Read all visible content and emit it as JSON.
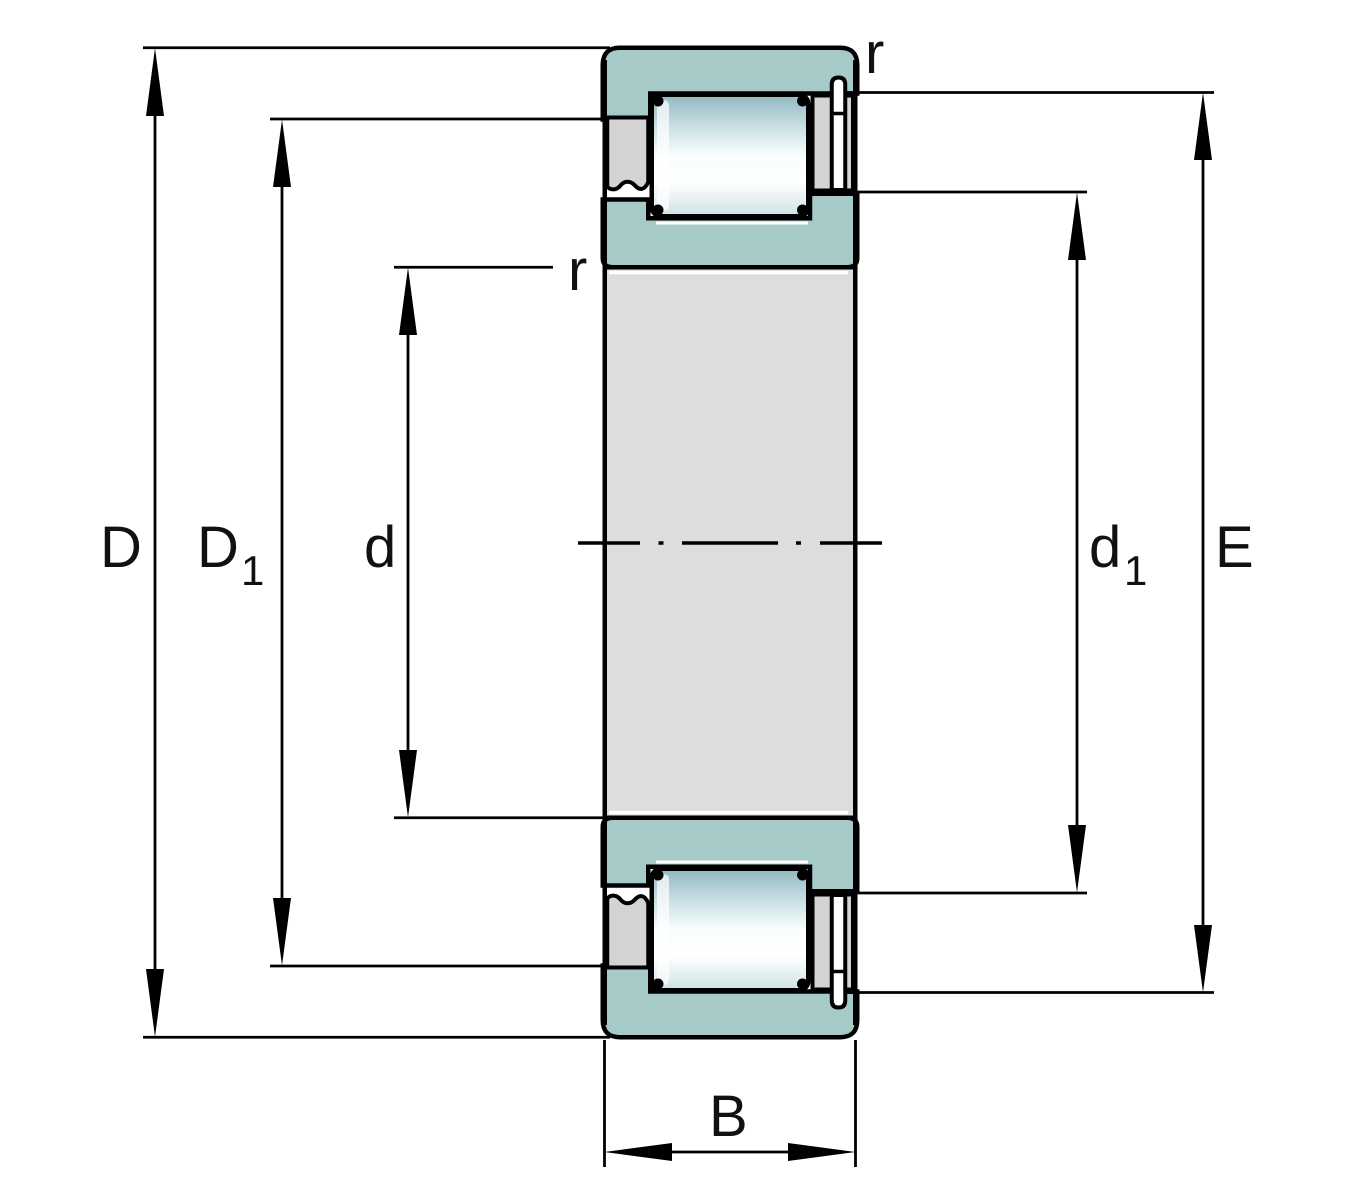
{
  "figure": {
    "title": "Cylindrical roller bearing cross-section dimension drawing"
  },
  "colors": {
    "background": "#ffffff",
    "ring_teal": "#a6cac7",
    "cage_gray": "#d4d4d4",
    "bore_gray": "#dcdddd",
    "washer_white": "#ffffff",
    "line_black": "#000000",
    "roller_gradient": {
      "top": "#8fb8bf",
      "upper_mid": "#cde2e6",
      "mid": "#f9fdfd",
      "lower_mid": "#ffffff",
      "bottom": "#cfe2e5"
    }
  },
  "dimensions": {
    "outside_diameter": {
      "symbol": "D"
    },
    "outer_flange_diameter": {
      "symbol": "D",
      "subscript": "1"
    },
    "bore_diameter": {
      "symbol": "d"
    },
    "inner_flange_diameter": {
      "symbol": "d",
      "subscript": "1"
    },
    "outer_raceway_diameter": {
      "symbol": "E"
    },
    "width": {
      "symbol": "B"
    },
    "outer_chamfer": {
      "symbol": "r"
    },
    "inner_chamfer": {
      "symbol": "r"
    }
  }
}
